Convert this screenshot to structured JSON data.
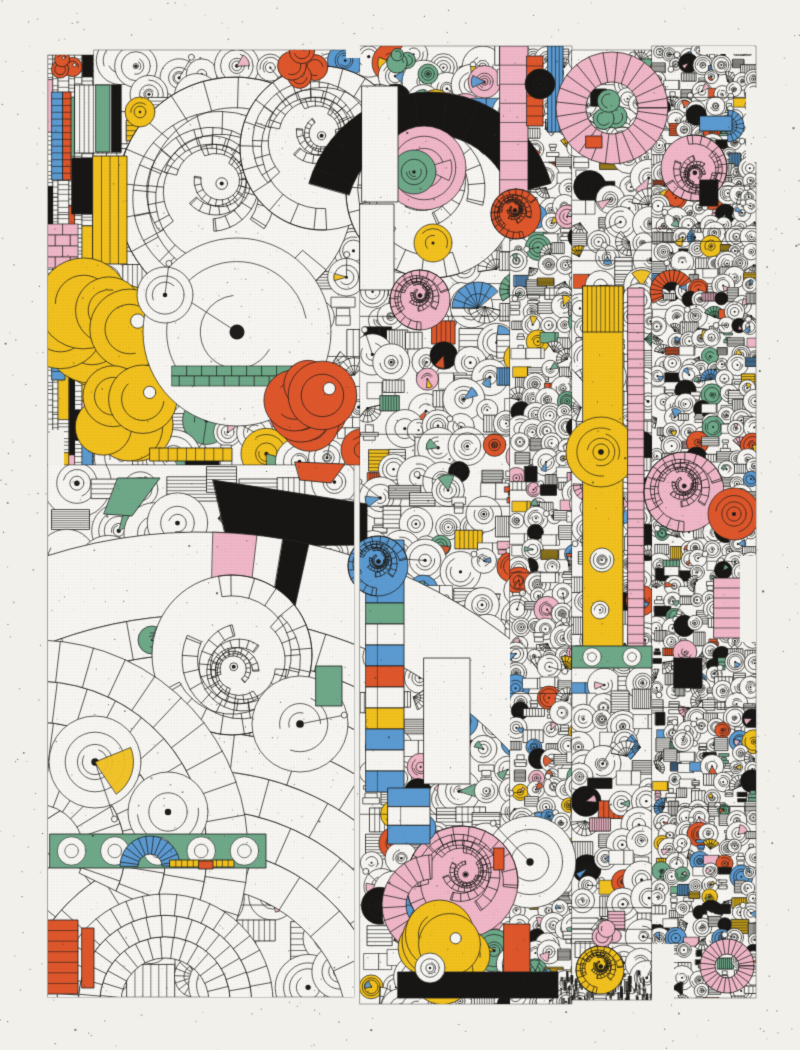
{
  "artwork": {
    "canvas": {
      "width": 800,
      "height": 1050
    },
    "seed": 7,
    "palette": {
      "paper": "#f1f0eb",
      "white": "#faf9f5",
      "ink": "#1d1c1a",
      "yellow": "#f4c31d",
      "orange": "#e2572b",
      "pink": "#f2b9ca",
      "blue": "#5c9cd4",
      "green": "#6faa8b",
      "black": "#161514",
      "speckle": "#30302c",
      "grid": "#55554f"
    },
    "grid": {
      "spacing": 3,
      "alpha": 0.1
    },
    "speckles": {
      "count": 1000
    },
    "art_noise": {
      "count": 2600
    },
    "regions": [
      {
        "name": "left-strip",
        "x": 48,
        "y": 55,
        "w": 46,
        "h": 410,
        "cell": 12,
        "style": "vbars",
        "colorProb": 0.3,
        "blackProb": 0.08
      },
      {
        "name": "top-left-block",
        "x": 94,
        "y": 50,
        "w": 268,
        "h": 415,
        "cell": 30,
        "style": "motifs",
        "colorProb": 0.08,
        "blackProb": 0.05
      },
      {
        "name": "big-arcs-block",
        "x": 48,
        "y": 465,
        "w": 306,
        "h": 532,
        "cell": 38,
        "style": "motifs",
        "colorProb": 0.05,
        "blackProb": 0.02
      },
      {
        "name": "center-column",
        "x": 360,
        "y": 46,
        "w": 150,
        "h": 958,
        "cell": 23,
        "style": "motifs",
        "colorProb": 0.13,
        "blackProb": 0.07
      },
      {
        "name": "mid-right-column",
        "x": 510,
        "y": 46,
        "w": 62,
        "h": 958,
        "cell": 15,
        "style": "motifs",
        "colorProb": 0.18,
        "blackProb": 0.08
      },
      {
        "name": "right-column",
        "x": 572,
        "y": 50,
        "w": 80,
        "h": 950,
        "cell": 20,
        "style": "motifs",
        "colorProb": 0.12,
        "blackProb": 0.06
      },
      {
        "name": "far-right-column",
        "x": 652,
        "y": 46,
        "w": 104,
        "h": 952,
        "cell": 13,
        "style": "motifs",
        "colorProb": 0.17,
        "blackProb": 0.09
      }
    ],
    "notches": [
      [
        746,
        88,
        12,
        74
      ],
      [
        700,
        46,
        54,
        8
      ],
      [
        652,
        944,
        22,
        56
      ],
      [
        48,
        430,
        16,
        36
      ],
      [
        346,
        46,
        14,
        12
      ],
      [
        740,
        556,
        16,
        86
      ]
    ],
    "features": [
      {
        "t": "swirl",
        "x": 235,
        "y": 195,
        "r": 118,
        "c": "white"
      },
      {
        "t": "swirl",
        "x": 322,
        "y": 148,
        "r": 82,
        "c": "white"
      },
      {
        "t": "swirl",
        "x": 432,
        "y": 192,
        "r": 86,
        "c": "white"
      },
      {
        "t": "ring",
        "x": 430,
        "y": 218,
        "r0": 84,
        "r1": 126,
        "a0": 196,
        "a1": 344,
        "c": "black"
      },
      {
        "t": "disc",
        "x": 424,
        "y": 168,
        "r": 42,
        "c": "pink"
      },
      {
        "t": "disc",
        "x": 414,
        "y": 172,
        "r": 22,
        "c": "green"
      },
      {
        "t": "disc",
        "x": 140,
        "y": 112,
        "r": 15,
        "c": "yellow"
      },
      {
        "t": "blob",
        "x": 300,
        "y": 66,
        "r": 30,
        "n": 4,
        "c": "orange"
      },
      {
        "t": "blob",
        "x": 64,
        "y": 64,
        "r": 18,
        "n": 3,
        "c": "orange"
      },
      {
        "t": "bar",
        "x": 75,
        "y": 85,
        "w": 46,
        "h": 68,
        "c": "white",
        "o": "v",
        "s": 9
      },
      {
        "t": "rect",
        "x": 96,
        "y": 85,
        "w": 14,
        "h": 67,
        "c": "green"
      },
      {
        "t": "rect",
        "x": 112,
        "y": 85,
        "w": 9,
        "h": 67,
        "c": "black"
      },
      {
        "t": "bar",
        "x": 93,
        "y": 156,
        "w": 34,
        "h": 108,
        "c": "yellow",
        "o": "v",
        "s": 3
      },
      {
        "t": "rect",
        "x": 72,
        "y": 158,
        "w": 20,
        "h": 56,
        "c": "black"
      },
      {
        "t": "bricks",
        "x": 48,
        "y": 224,
        "w": 30,
        "h": 44,
        "c": "pink"
      },
      {
        "t": "bar",
        "x": 52,
        "y": 92,
        "w": 11,
        "h": 88,
        "c": "blue",
        "o": "h",
        "s": 12
      },
      {
        "t": "bar",
        "x": 63,
        "y": 92,
        "w": 8,
        "h": 88,
        "c": "orange",
        "o": "h",
        "s": 12
      },
      {
        "t": "bar",
        "x": 52,
        "y": 286,
        "w": 13,
        "h": 94,
        "c": "blue",
        "o": "h",
        "s": 10
      },
      {
        "t": "blob",
        "x": 100,
        "y": 330,
        "r": 78,
        "n": 8,
        "c": "yellow"
      },
      {
        "t": "blob",
        "x": 128,
        "y": 418,
        "r": 55,
        "n": 5,
        "c": "yellow"
      },
      {
        "t": "disc",
        "x": 237,
        "y": 332,
        "r": 94,
        "c": "white",
        "pin": true
      },
      {
        "t": "disc",
        "x": 165,
        "y": 295,
        "r": 28,
        "c": "white",
        "pin": true
      },
      {
        "t": "bricks",
        "x": 172,
        "y": 366,
        "w": 126,
        "h": 20,
        "c": "green"
      },
      {
        "t": "blob",
        "x": 308,
        "y": 405,
        "r": 52,
        "n": 6,
        "c": "orange"
      },
      {
        "t": "bar",
        "x": 150,
        "y": 448,
        "w": 82,
        "h": 13,
        "c": "yellow",
        "o": "v",
        "s": 8
      },
      {
        "t": "poly",
        "p": [
          [
            118,
            478
          ],
          [
            160,
            478
          ],
          [
            132,
            516
          ],
          [
            104,
            514
          ]
        ],
        "c": "green"
      },
      {
        "t": "poly",
        "p": [
          [
            295,
            462
          ],
          [
            345,
            464
          ],
          [
            331,
            483
          ],
          [
            300,
            480
          ]
        ],
        "c": "orange"
      },
      {
        "t": "poly",
        "p": [
          [
            213,
            480
          ],
          [
            367,
            504
          ],
          [
            367,
            545
          ],
          [
            228,
            546
          ]
        ],
        "c": "black"
      },
      {
        "t": "ringband",
        "x": 200,
        "y": 1035,
        "r0": 420,
        "r1": 503,
        "a0": -178,
        "a1": -4,
        "c": "white",
        "clip": [
          48,
          430,
          462,
          320
        ],
        "fills": [
          {
            "a": -86,
            "s": 5,
            "c": "pink"
          },
          {
            "a": -79,
            "s": 3,
            "c": "black"
          }
        ]
      },
      {
        "t": "arcfan",
        "x": 200,
        "y": 1035,
        "r0": 148,
        "r1": 420,
        "a0": -178,
        "a1": -3,
        "n": 7,
        "clip": [
          48,
          465,
          306,
          532
        ],
        "fills": [
          {
            "b": 4,
            "a": -103,
            "s": 9,
            "c": "yellow"
          },
          {
            "b": 5,
            "a": -106,
            "s": 9,
            "c": "yellow"
          },
          {
            "b": 3,
            "a": -99,
            "s": 8,
            "c": "yellow"
          },
          {
            "b": 6,
            "a": -84,
            "s": 3,
            "c": "black"
          },
          {
            "b": 6,
            "a": -88,
            "s": 3,
            "c": "black"
          }
        ]
      },
      {
        "t": "disc",
        "x": 152,
        "y": 640,
        "r": 14,
        "c": "green"
      },
      {
        "t": "swirl",
        "x": 232,
        "y": 655,
        "r": 80,
        "c": "white"
      },
      {
        "t": "arcfan",
        "x": 36,
        "y": 852,
        "r0": 48,
        "r1": 212,
        "a0": -88,
        "a1": 26,
        "n": 4,
        "clip": [
          48,
          465,
          306,
          532
        ],
        "fills": []
      },
      {
        "t": "arcfan",
        "x": 165,
        "y": 1002,
        "r0": 44,
        "r1": 108,
        "a0": -180,
        "a1": 0,
        "n": 3,
        "clip": [
          48,
          465,
          306,
          532
        ],
        "fills": []
      },
      {
        "t": "disc",
        "x": 95,
        "y": 762,
        "r": 46,
        "c": "white",
        "pin": true
      },
      {
        "t": "disc",
        "x": 168,
        "y": 812,
        "r": 40,
        "c": "white"
      },
      {
        "t": "disc",
        "x": 300,
        "y": 724,
        "r": 48,
        "c": "white",
        "pin": true
      },
      {
        "t": "band",
        "x": 50,
        "y": 834,
        "w": 216,
        "h": 34,
        "c": "green"
      },
      {
        "t": "ring",
        "x": 150,
        "y": 866,
        "r0": 12,
        "r1": 30,
        "a0": 180,
        "a1": 360,
        "c": "blue"
      },
      {
        "t": "bar",
        "x": 170,
        "y": 860,
        "w": 64,
        "h": 7,
        "c": "yellow",
        "o": "v",
        "s": 10
      },
      {
        "t": "rect",
        "x": 199,
        "y": 861,
        "w": 14,
        "h": 8,
        "c": "orange"
      },
      {
        "t": "bar",
        "x": 48,
        "y": 920,
        "w": 30,
        "h": 74,
        "c": "orange",
        "o": "h",
        "s": 6
      },
      {
        "t": "rect",
        "x": 82,
        "y": 928,
        "w": 12,
        "h": 60,
        "c": "orange"
      },
      {
        "t": "rect",
        "x": 362,
        "y": 86,
        "w": 36,
        "h": 116,
        "c": "white"
      },
      {
        "t": "rect",
        "x": 360,
        "y": 204,
        "w": 34,
        "h": 86,
        "c": "white"
      },
      {
        "t": "disc",
        "x": 433,
        "y": 243,
        "r": 19,
        "c": "yellow"
      },
      {
        "t": "blob",
        "x": 400,
        "y": 60,
        "r": 16,
        "n": 3,
        "c": "green"
      },
      {
        "t": "disc",
        "x": 428,
        "y": 74,
        "r": 10,
        "c": "green"
      },
      {
        "t": "swirl",
        "x": 420,
        "y": 300,
        "r": 30,
        "c": "pink"
      },
      {
        "t": "fan",
        "x": 478,
        "y": 308,
        "r": 26,
        "a0": 180,
        "a1": 320,
        "c": "blue"
      },
      {
        "t": "segbar",
        "x": 366,
        "y": 540,
        "w": 38,
        "h": 252,
        "cs": [
          "blue",
          "white",
          "blue",
          "green",
          "white",
          "blue",
          "orange",
          "white",
          "yellow",
          "blue",
          "white",
          "blue"
        ]
      },
      {
        "t": "swirl",
        "x": 378,
        "y": 566,
        "r": 30,
        "c": "blue"
      },
      {
        "t": "rect",
        "x": 316,
        "y": 666,
        "w": 26,
        "h": 40,
        "c": "green"
      },
      {
        "t": "rect",
        "x": 424,
        "y": 658,
        "w": 46,
        "h": 126,
        "c": "white"
      },
      {
        "t": "disc",
        "x": 530,
        "y": 862,
        "r": 46,
        "c": "white",
        "pin": true
      },
      {
        "t": "swirl",
        "x": 462,
        "y": 882,
        "r": 56,
        "c": "pink"
      },
      {
        "t": "ring",
        "x": 432,
        "y": 905,
        "r0": 26,
        "r1": 50,
        "a0": 80,
        "a1": 270,
        "c": "pink"
      },
      {
        "t": "disc",
        "x": 422,
        "y": 828,
        "r": 14,
        "c": "blue"
      },
      {
        "t": "segbar",
        "x": 388,
        "y": 788,
        "w": 42,
        "h": 56,
        "cs": [
          "blue",
          "white",
          "blue"
        ]
      },
      {
        "t": "blob",
        "x": 442,
        "y": 946,
        "r": 54,
        "n": 7,
        "c": "yellow"
      },
      {
        "t": "rect",
        "x": 504,
        "y": 924,
        "w": 26,
        "h": 72,
        "c": "orange"
      },
      {
        "t": "rect",
        "x": 494,
        "y": 848,
        "w": 10,
        "h": 22,
        "c": "orange"
      },
      {
        "t": "rect",
        "x": 398,
        "y": 972,
        "w": 160,
        "h": 26,
        "c": "black"
      },
      {
        "t": "dashes",
        "x": 560,
        "y": 970,
        "w": 100,
        "h": 28
      },
      {
        "t": "disc",
        "x": 430,
        "y": 968,
        "r": 15,
        "c": "white"
      },
      {
        "t": "bar",
        "x": 500,
        "y": 46,
        "w": 28,
        "h": 172,
        "c": "pink",
        "o": "h",
        "s": 8
      },
      {
        "t": "bar",
        "x": 527,
        "y": 56,
        "w": 16,
        "h": 70,
        "c": "orange",
        "o": "h",
        "s": 6
      },
      {
        "t": "bar",
        "x": 548,
        "y": 46,
        "w": 15,
        "h": 86,
        "c": "blue",
        "o": "v",
        "s": 3
      },
      {
        "t": "swirl",
        "x": 516,
        "y": 214,
        "r": 25,
        "c": "orange"
      },
      {
        "t": "disc",
        "x": 540,
        "y": 84,
        "r": 15,
        "c": "black"
      },
      {
        "t": "rect",
        "x": 583,
        "y": 286,
        "w": 40,
        "h": 368,
        "c": "yellow"
      },
      {
        "t": "bar",
        "x": 583,
        "y": 286,
        "w": 40,
        "h": 46,
        "c": "yellow",
        "o": "v",
        "s": 8
      },
      {
        "t": "disc",
        "x": 601,
        "y": 452,
        "r": 35,
        "c": "yellow"
      },
      {
        "t": "disc",
        "x": 602,
        "y": 560,
        "r": 12,
        "c": "white"
      },
      {
        "t": "disc",
        "x": 600,
        "y": 610,
        "r": 9,
        "c": "white"
      },
      {
        "t": "bar",
        "x": 628,
        "y": 288,
        "w": 16,
        "h": 364,
        "c": "pink",
        "o": "h",
        "s": 40
      },
      {
        "t": "band",
        "x": 572,
        "y": 646,
        "w": 80,
        "h": 22,
        "c": "green"
      },
      {
        "t": "bar",
        "x": 714,
        "y": 578,
        "w": 28,
        "h": 60,
        "c": "pink",
        "o": "h",
        "s": 5
      },
      {
        "t": "swirl",
        "x": 684,
        "y": 492,
        "r": 40,
        "c": "pink"
      },
      {
        "t": "disc",
        "x": 734,
        "y": 514,
        "r": 26,
        "c": "orange"
      },
      {
        "t": "ring",
        "x": 612,
        "y": 108,
        "r0": 26,
        "r1": 56,
        "a0": 0,
        "a1": 360,
        "c": "pink"
      },
      {
        "t": "blob",
        "x": 608,
        "y": 114,
        "r": 24,
        "n": 3,
        "c": "green"
      },
      {
        "t": "rect",
        "x": 586,
        "y": 136,
        "w": 16,
        "h": 12,
        "c": "orange"
      },
      {
        "t": "swirl",
        "x": 694,
        "y": 168,
        "r": 33,
        "c": "pink"
      },
      {
        "t": "fan",
        "x": 728,
        "y": 126,
        "r": 16,
        "a0": -90,
        "a1": 90,
        "c": "blue"
      },
      {
        "t": "rect",
        "x": 700,
        "y": 116,
        "w": 32,
        "h": 15,
        "c": "blue"
      },
      {
        "t": "ring",
        "x": 672,
        "y": 292,
        "r0": 10,
        "r1": 22,
        "a0": 150,
        "a1": 330,
        "c": "orange"
      },
      {
        "t": "rect",
        "x": 674,
        "y": 658,
        "w": 28,
        "h": 30,
        "c": "black"
      },
      {
        "t": "rect",
        "x": 700,
        "y": 180,
        "w": 18,
        "h": 26,
        "c": "black"
      },
      {
        "t": "ring",
        "x": 727,
        "y": 966,
        "r0": 12,
        "r1": 27,
        "a0": 0,
        "a1": 360,
        "c": "pink"
      },
      {
        "t": "swirl",
        "x": 600,
        "y": 970,
        "r": 24,
        "c": "yellow"
      },
      {
        "t": "blob",
        "x": 608,
        "y": 932,
        "r": 16,
        "n": 3,
        "c": "pink"
      }
    ]
  }
}
